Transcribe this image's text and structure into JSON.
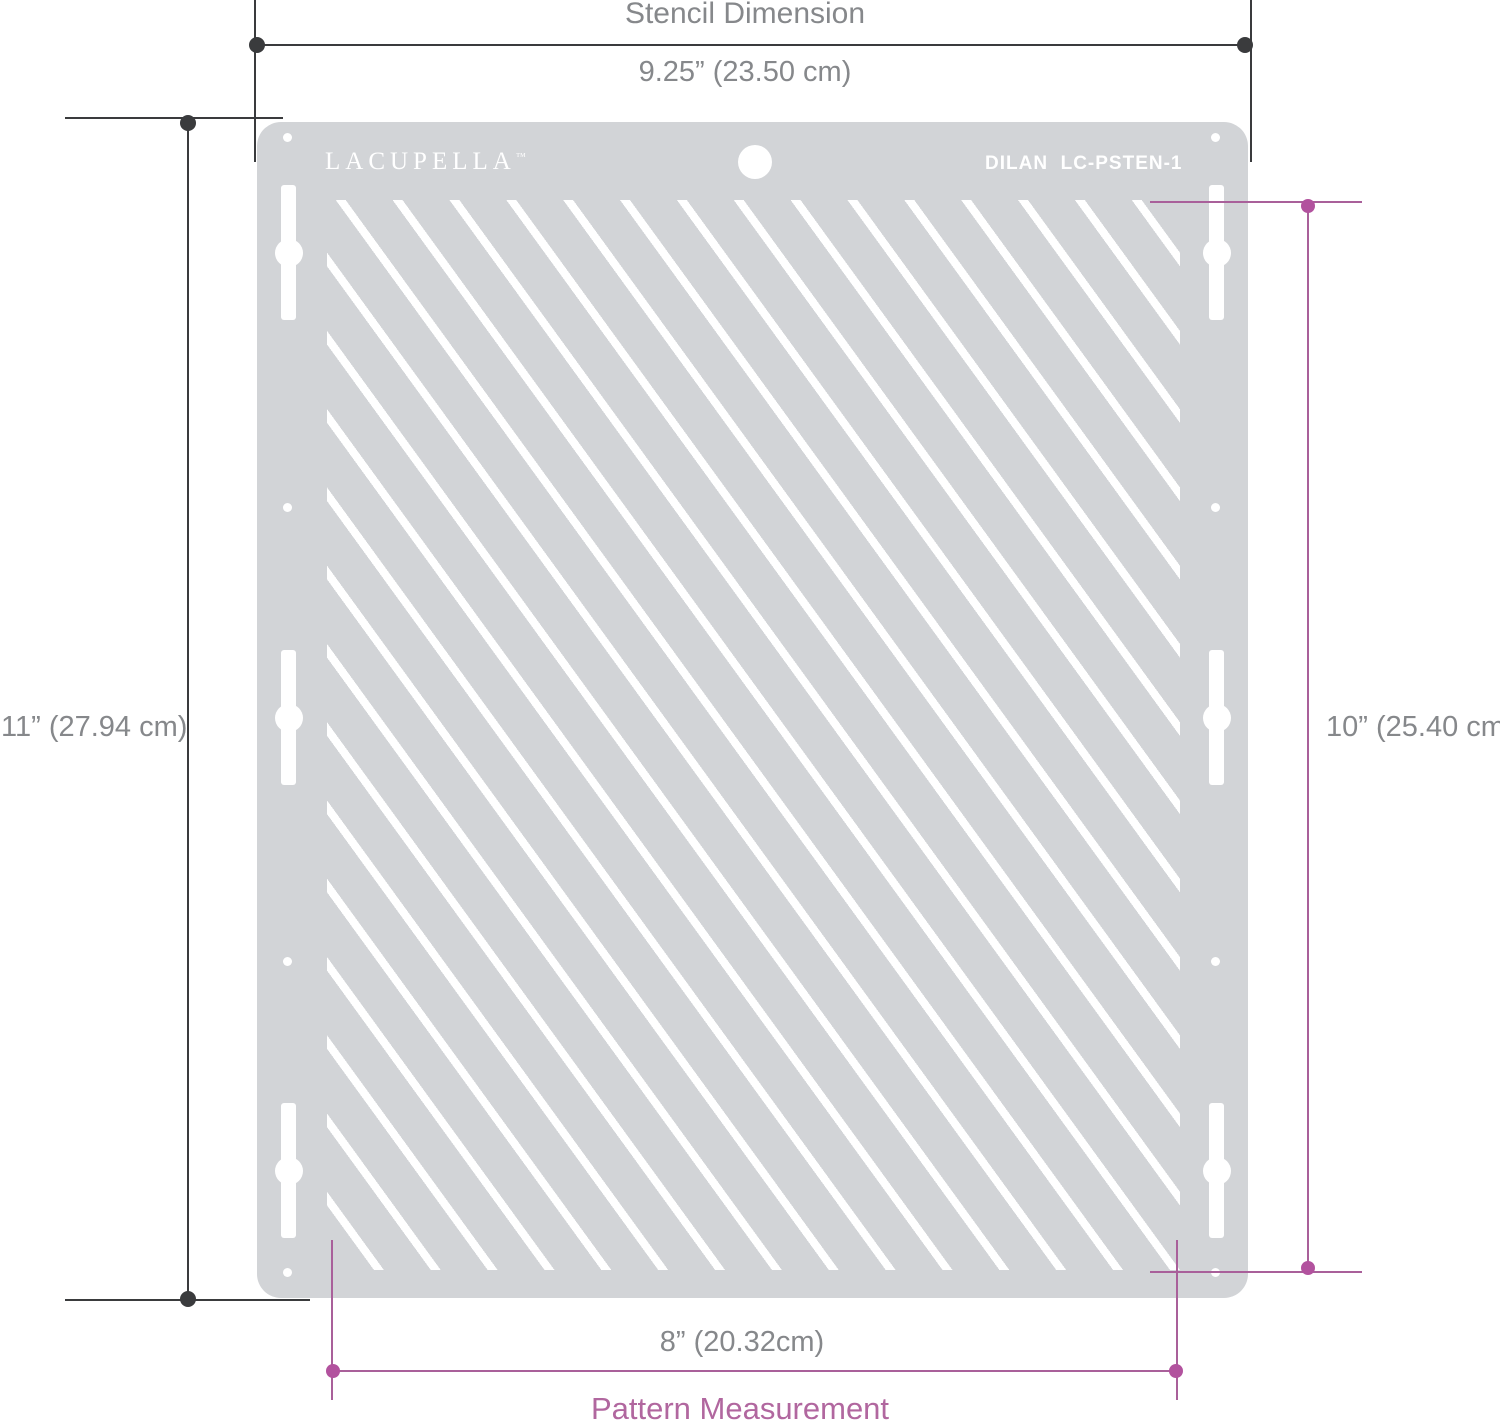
{
  "title": "Stencil Dimension",
  "stencil": {
    "brand": "LACUPELLA",
    "brand_trademark": "™",
    "part_number": "DILAN  LC-PSTEN-1"
  },
  "dimensions": {
    "stencil_width": "9.25” (23.50 cm)",
    "stencil_height": "11” (27.94 cm)",
    "pattern_height": "10” (25.40 cm)",
    "pattern_width": "8” (20.32cm)",
    "pattern_caption": "Pattern Measurement"
  },
  "colors": {
    "plate-gray": "#d2d4d7",
    "stripe-white": "#ffffff",
    "dim-dark": "#3a3b3d",
    "text-gray": "#86888b",
    "accent-line": "#a9609a",
    "accent-dot": "#b2529e",
    "accent-text": "#b1679f"
  }
}
